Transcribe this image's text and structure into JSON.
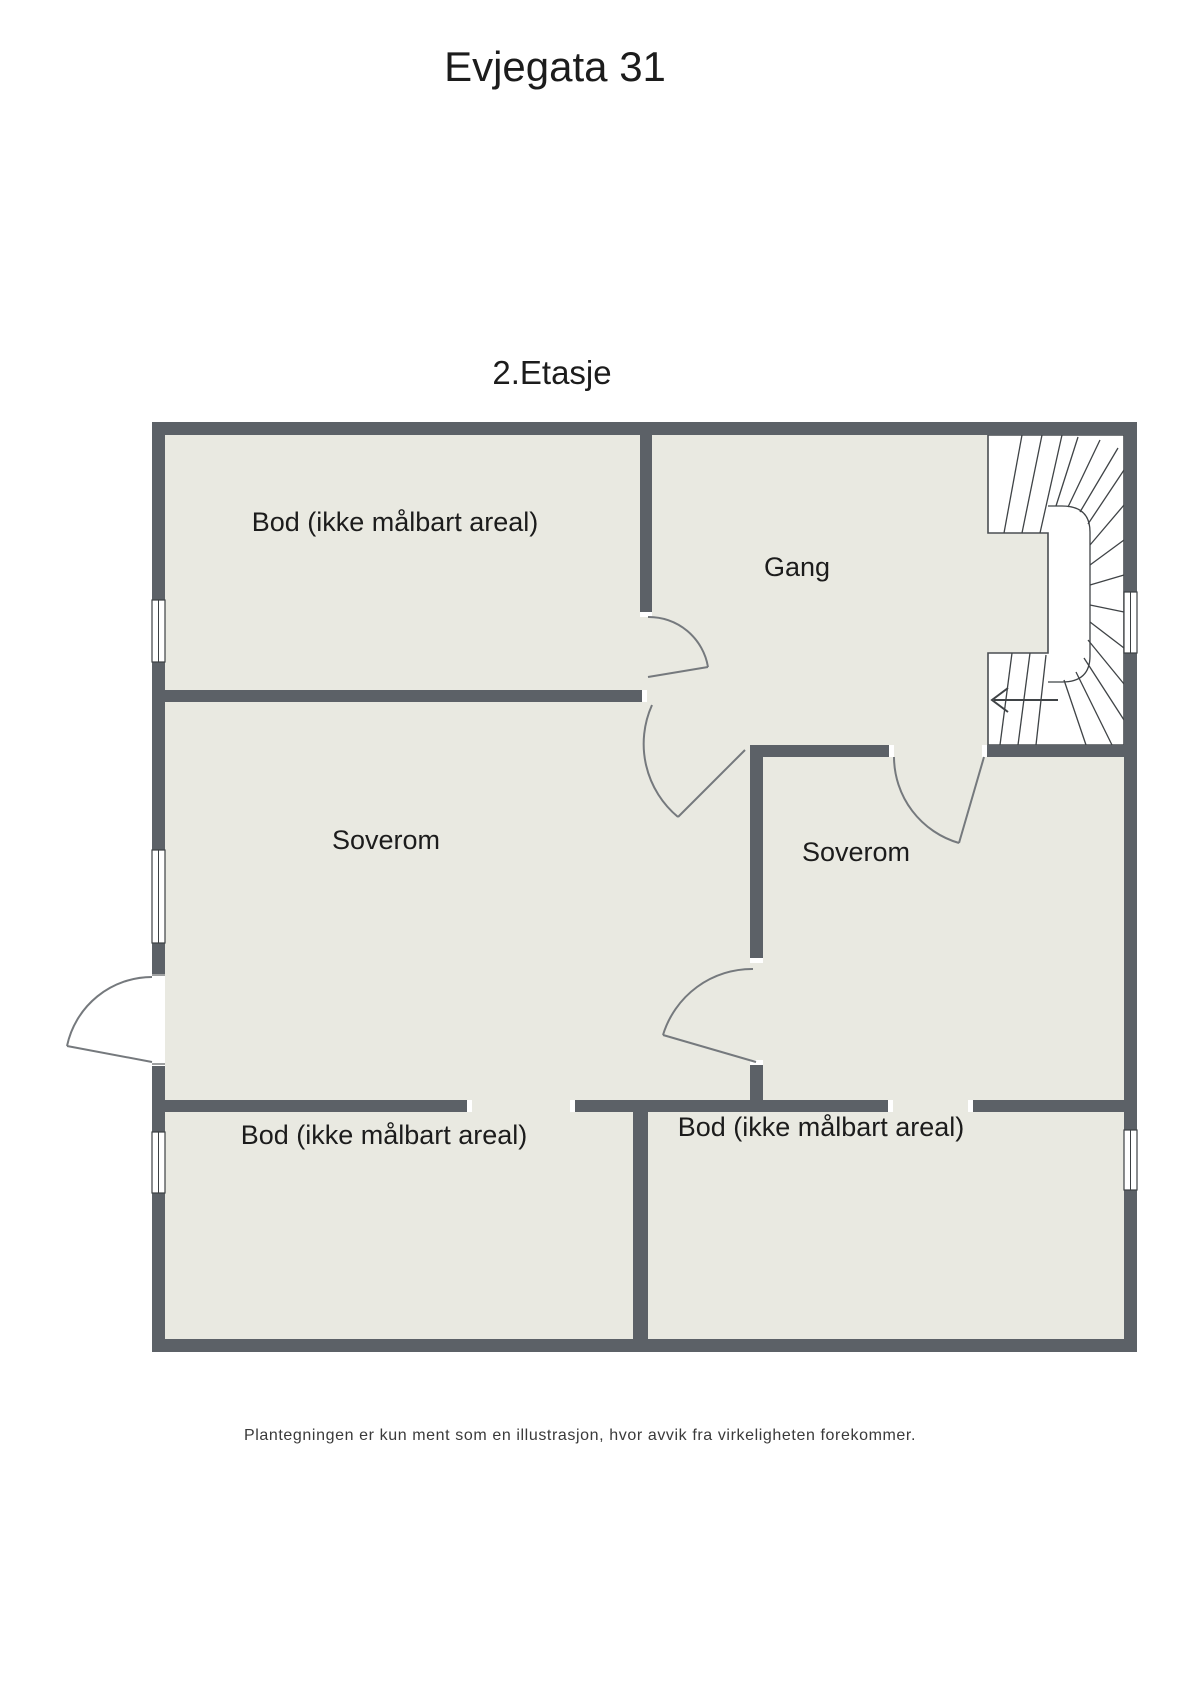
{
  "title": "Evjegata 31",
  "floor_label": "2.Etasje",
  "rooms": [
    {
      "name": "bod-top-left",
      "label": "Bod (ikke målbart areal)"
    },
    {
      "name": "gang",
      "label": "Gang"
    },
    {
      "name": "soverom-left",
      "label": "Soverom"
    },
    {
      "name": "soverom-right",
      "label": "Soverom"
    },
    {
      "name": "bod-bottom-left",
      "label": "Bod (ikke målbart areal)"
    },
    {
      "name": "bod-bottom-right",
      "label": "Bod (ikke målbart areal)"
    }
  ],
  "footer": "Plantegningen er kun ment som en illustrasjon, hvor avvik fra virkeligheten forekommer.",
  "colors": {
    "background": "#ffffff",
    "floor": "#e9e9e1",
    "wall": "#5c6167",
    "stair_line": "#3f4346",
    "text": "#1c1c1c"
  }
}
